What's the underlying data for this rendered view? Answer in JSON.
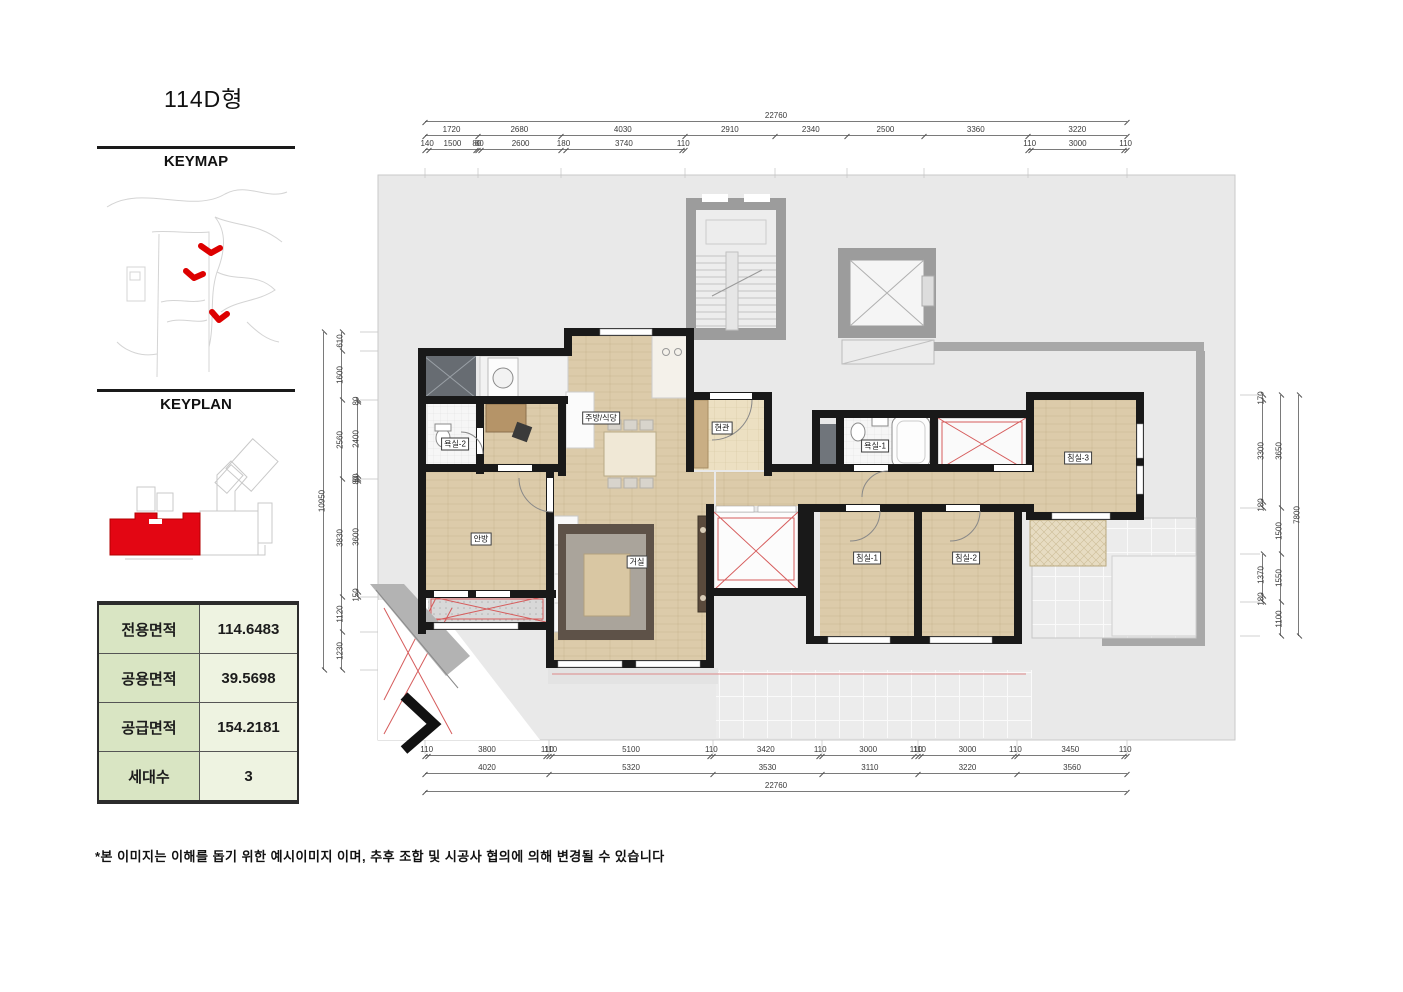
{
  "page": {
    "title": "114D형",
    "footnote": "*본 이미지는 이해를 돕기 위한 예시이미지 이며, 추후 조합 및 시공사 협의에 의해 변경될 수 있습니다"
  },
  "sidebar": {
    "keymap_label": "KEYMAP",
    "keyplan_label": "KEYPLAN",
    "table": {
      "rows": [
        {
          "label": "전용면적",
          "value": "114.6483"
        },
        {
          "label": "공용면적",
          "value": "39.5698"
        },
        {
          "label": "공급면적",
          "value": "154.2181"
        },
        {
          "label": "세대수",
          "value": "3"
        }
      ]
    }
  },
  "plan": {
    "rooms": {
      "kitchen_dining": "주방/식당",
      "entrance": "현관",
      "bath2": "욕실-2",
      "bath1": "욕실-1",
      "master": "안방",
      "living": "거실",
      "bed1": "침실-1",
      "bed2": "침실-2",
      "bed3": "침실-3"
    },
    "dims": {
      "top_total": "22760",
      "top_tier2": [
        1720,
        2680,
        4030,
        2910,
        2340,
        2500,
        3360,
        3220
      ],
      "top_tier3_left": [
        140,
        1500,
        80,
        80,
        2600,
        180,
        3740,
        110
      ],
      "top_tier3_right": [
        110,
        3000,
        110
      ],
      "bottom_tier1": [
        110,
        3800,
        110,
        110,
        5100,
        110,
        3420,
        110,
        3000,
        110,
        110,
        3000,
        110,
        3450,
        110
      ],
      "bottom_tier2": [
        4020,
        5320,
        3530,
        3110,
        3220,
        3560
      ],
      "bottom_total": "22760",
      "left_total": "10950",
      "left_mid": [
        610,
        1600,
        2560,
        3830,
        1120,
        1230
      ],
      "left_inner": [
        80,
        2400,
        80,
        80,
        3600,
        150
      ],
      "right_inner_top": [
        170,
        3300,
        180
      ],
      "right_inner_bottom": [
        1370,
        180
      ],
      "right_mid": [
        3650,
        1500,
        1550,
        1100
      ],
      "right_total": "7800"
    }
  },
  "colors": {
    "accent_red": "#d65c5c",
    "keymap_highlight": "#dd0000",
    "table_label_bg": "#d9e5c3",
    "table_value_bg": "#eef3e1",
    "wood_floor": "#dccbaa",
    "slab_gray": "#e9e9e9",
    "wall_black": "#191919"
  }
}
